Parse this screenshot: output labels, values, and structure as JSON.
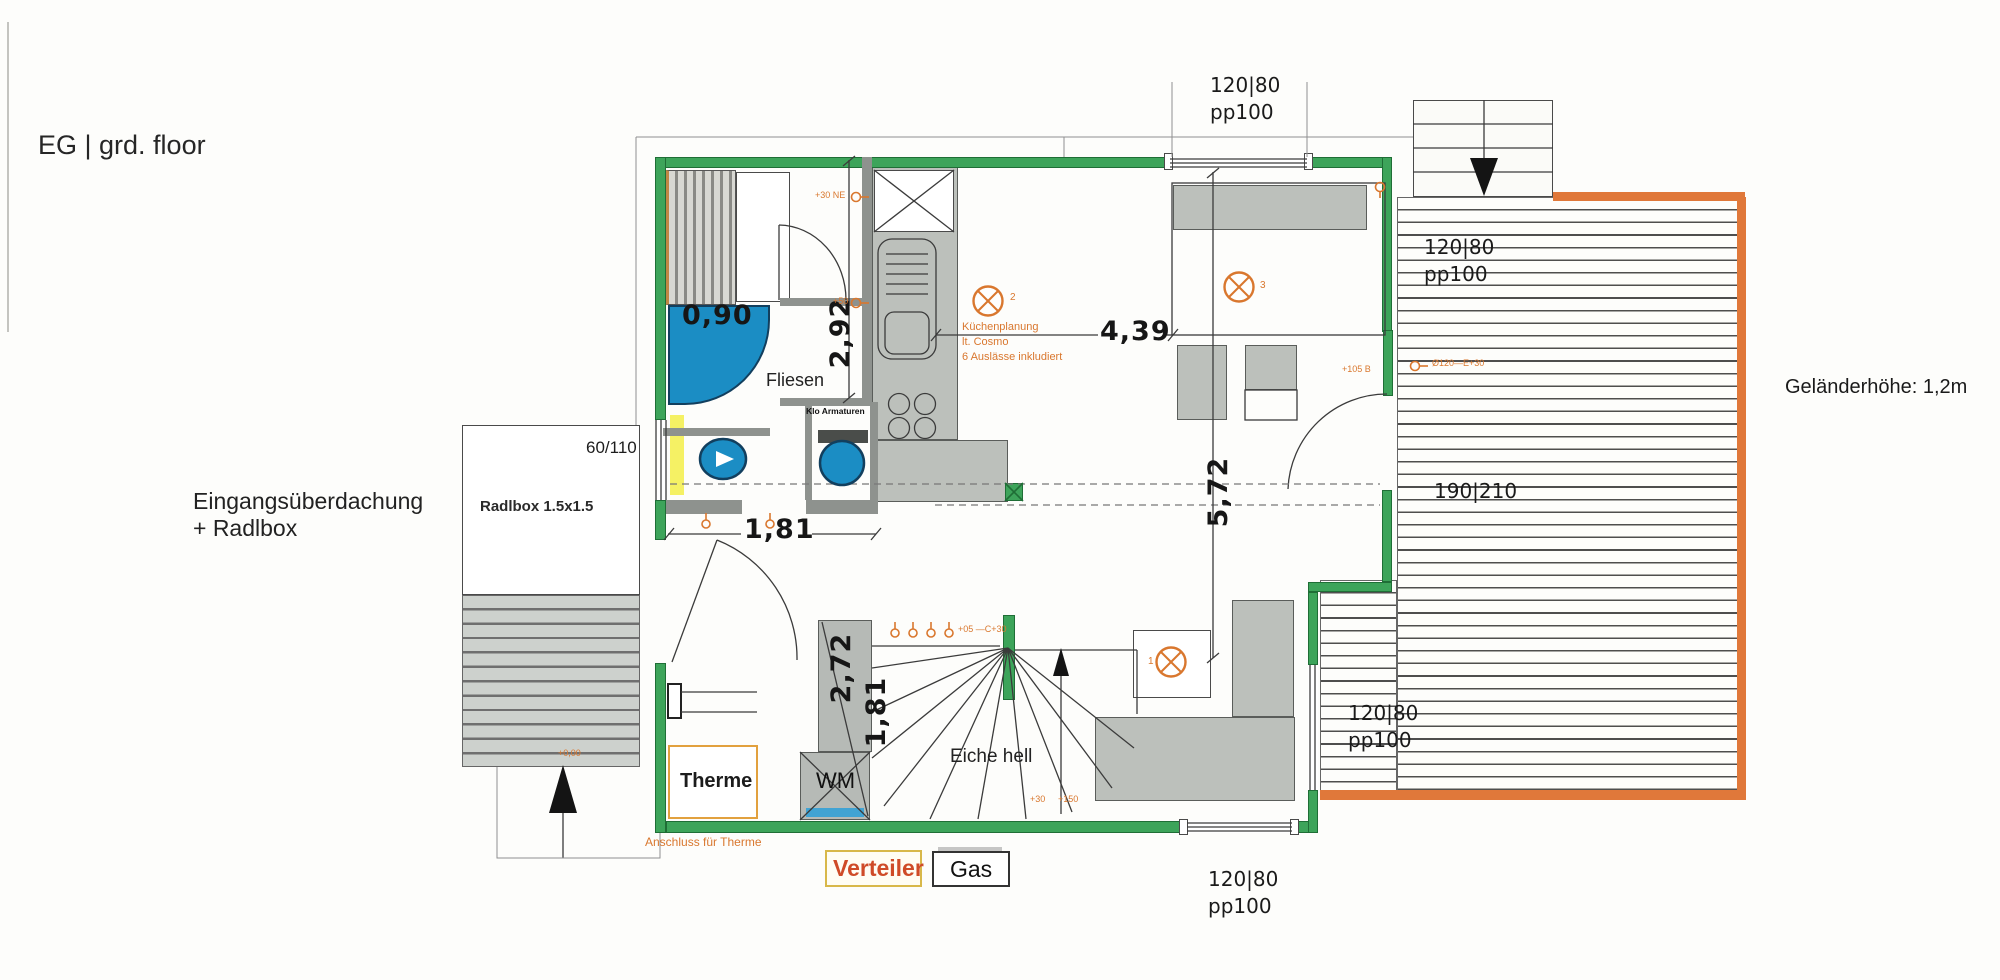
{
  "title": "EG | grd. floor",
  "notes": {
    "entrance_line1": "Eingangsüberdachung",
    "entrance_line2": "+ Radlbox",
    "radlbox_size": "Radlbox 1.5x1.5",
    "entry_window": "60/110",
    "entry_level_mark": "+0,00",
    "railing": "Geländerhöhe: 1,2m",
    "therme_connection": "Anschluss für Therme"
  },
  "window_labels": {
    "top": {
      "size": "120|80",
      "type": "pp100"
    },
    "terrace_upper": {
      "size": "120|80",
      "type": "pp100"
    },
    "terrace_lower": {
      "size": "120|80",
      "type": "pp100"
    },
    "bottom": {
      "size": "120|80",
      "type": "pp100"
    },
    "terrace_door": "190|210"
  },
  "dimensions": {
    "shower_width": "0,90",
    "bath_depth": "2,92",
    "hall_width": "1,81",
    "living_width": "4,39",
    "living_depth": "5,72",
    "stair_run": "2,72",
    "stair_width": "1,81"
  },
  "labels": {
    "tiles": "Fliesen",
    "stairs_material": "Eiche hell",
    "boiler": "Therme",
    "washing_machine": "WM",
    "distributor": "Verteiler",
    "gas": "Gas",
    "wc_fittings": "Klo Armaturen"
  },
  "electrical": {
    "kitchen_note": [
      "Küchenplanung",
      "lt. Cosmo",
      "6 Auslässe inkludiert"
    ],
    "lamp_ids": {
      "living": "1",
      "kitchen": "2",
      "bedroom": "3"
    },
    "tags": {
      "kitchen_top": "+30 NE",
      "kitchen_mid": "+50",
      "stair_row": "+05 —C+30",
      "stair_30": "+30",
      "stair_150": "+150",
      "door_left": "+105 B",
      "door_right": "Ø120—E+30"
    }
  },
  "colors": {
    "wall_green": "#3da45a",
    "fixture_blue": "#1b8dc4",
    "annotation_orange": "#d9772e",
    "deck_border_orange": "#e0783a"
  }
}
